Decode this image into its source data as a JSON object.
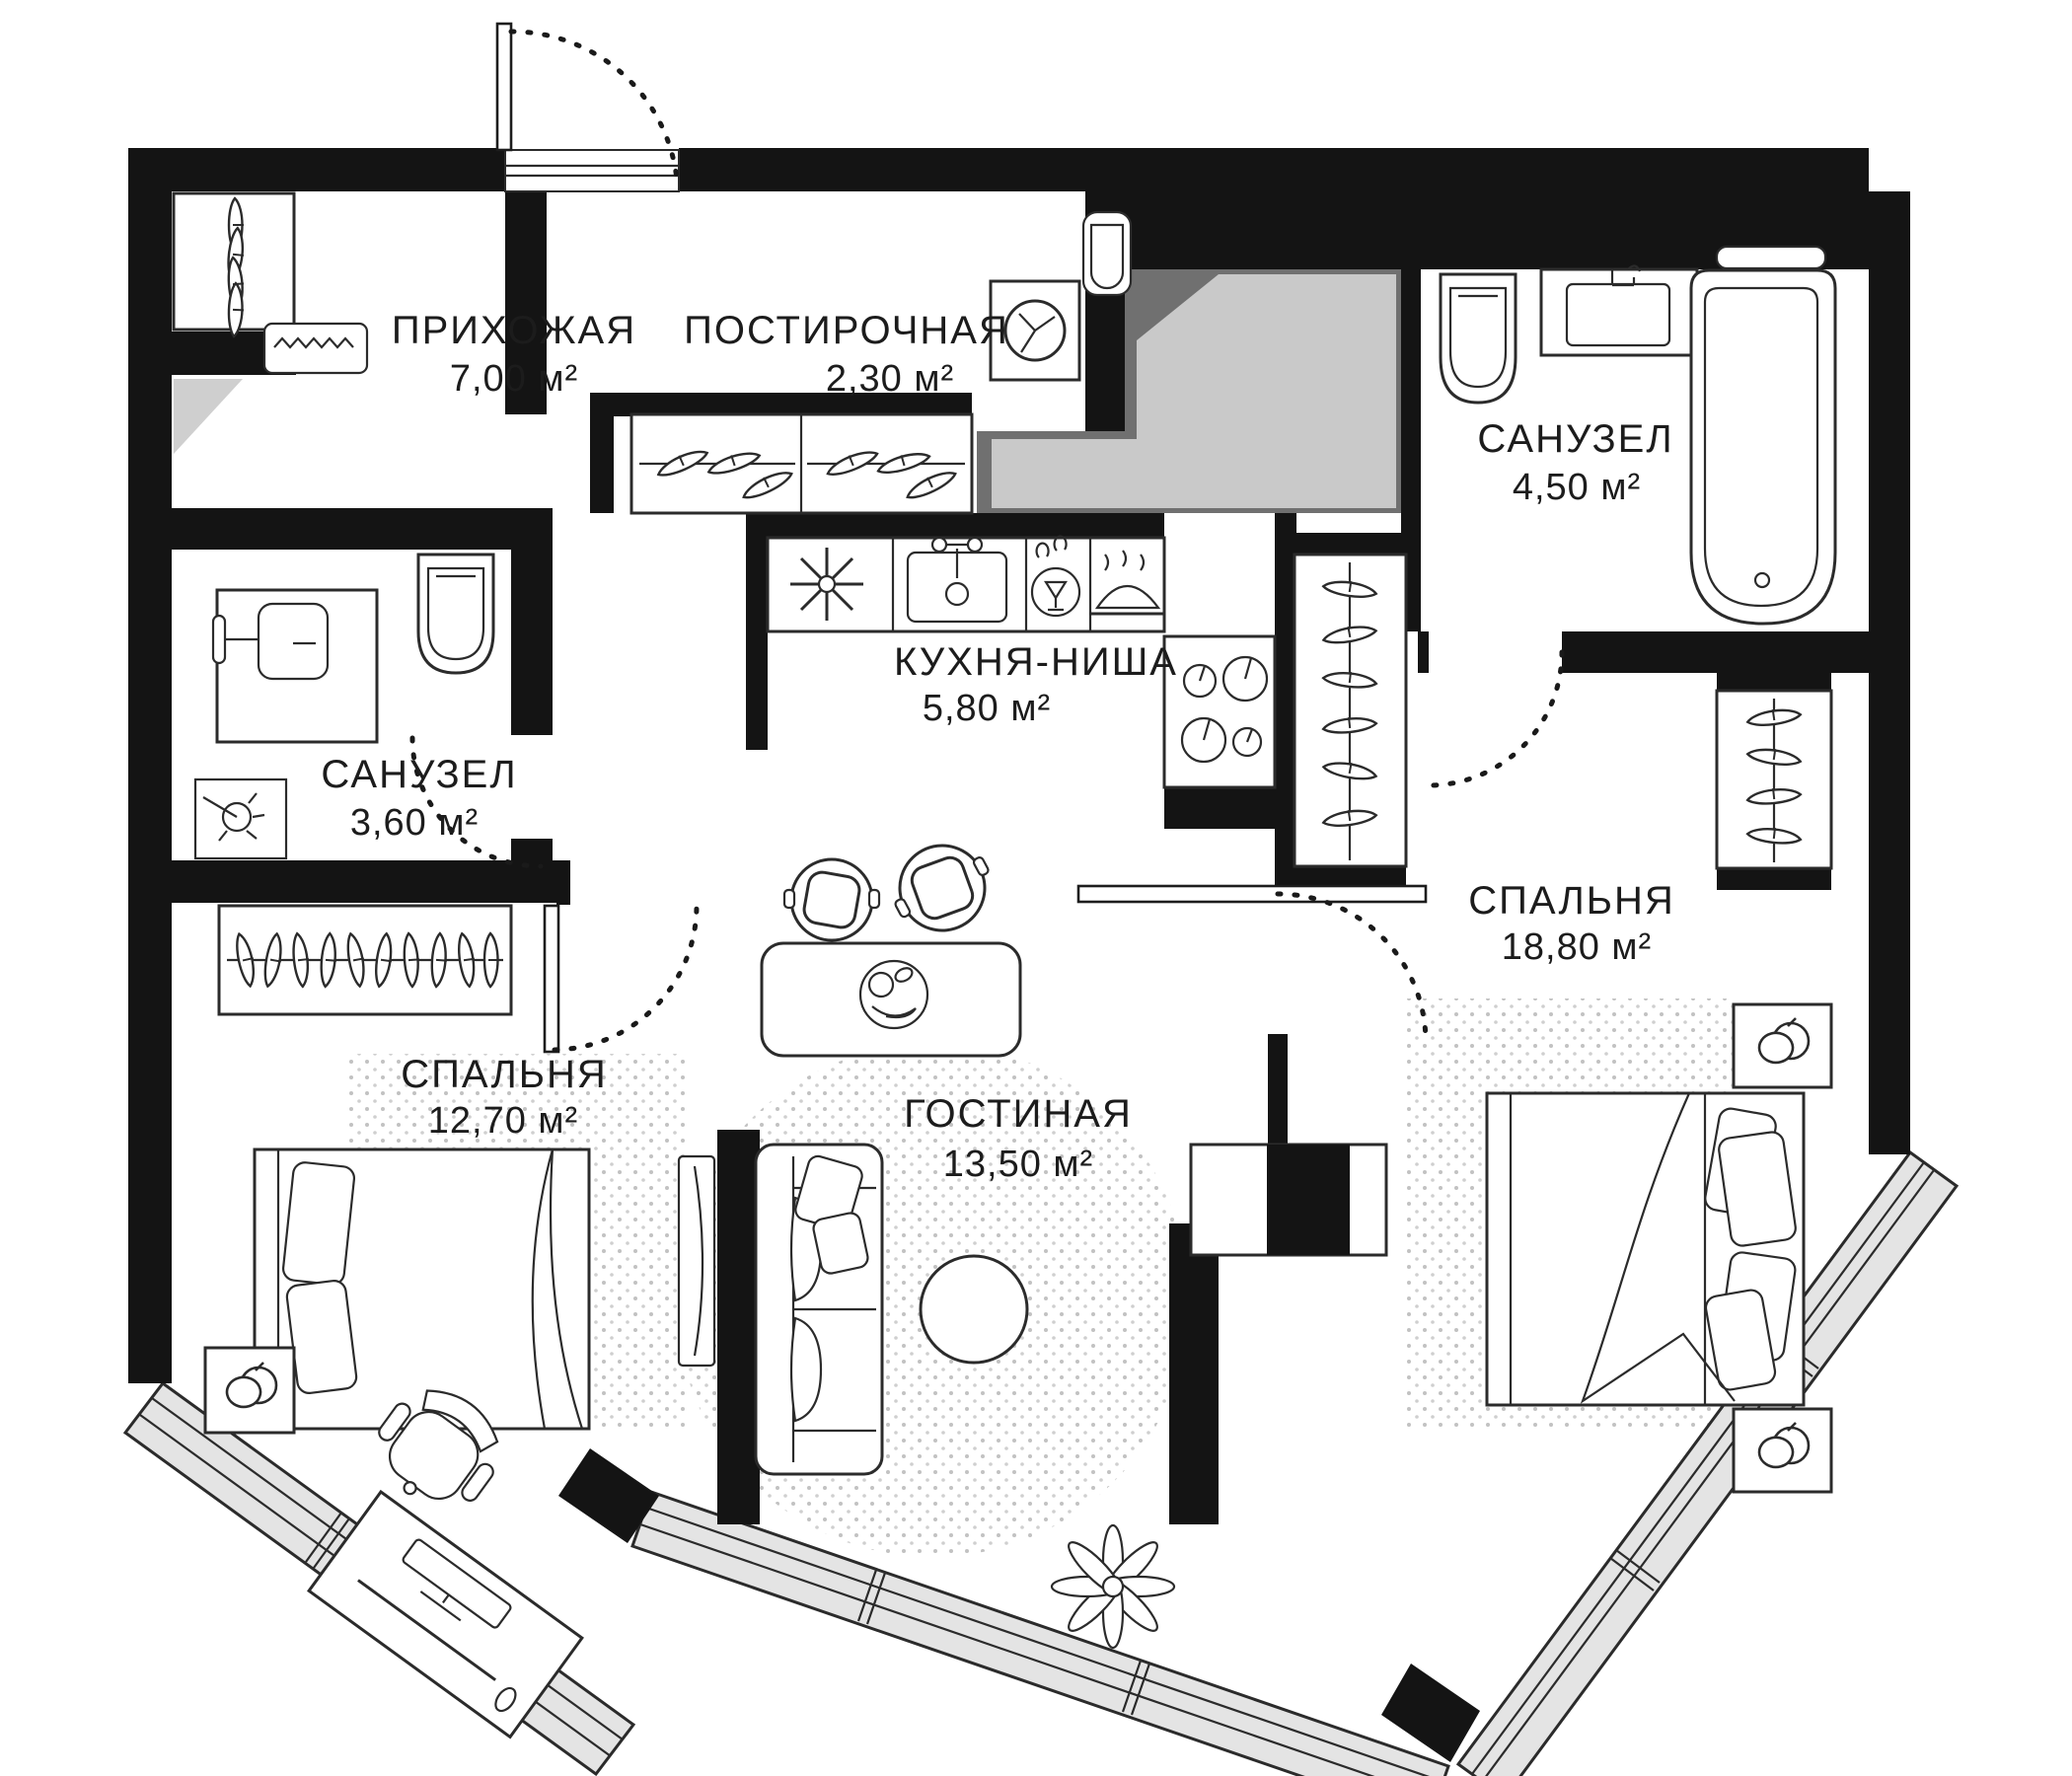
{
  "plan": {
    "type": "apartment-floor-plan",
    "units_symbol": "м²",
    "rooms": [
      {
        "id": "hallway",
        "name": "ПРИХОЖАЯ",
        "area": "7,00 м²"
      },
      {
        "id": "laundry",
        "name": "ПОСТИРОЧНАЯ",
        "area": "2,30 м²"
      },
      {
        "id": "bathroom-right",
        "name": "САНУЗЕЛ",
        "area": "4,50 м²"
      },
      {
        "id": "kitchen-niche",
        "name": "КУХНЯ-НИША",
        "area": "5,80 м²"
      },
      {
        "id": "bathroom-left",
        "name": "САНУЗЕЛ",
        "area": "3,60 м²"
      },
      {
        "id": "bedroom-right",
        "name": "СПАЛЬНЯ",
        "area": "18,80 м²"
      },
      {
        "id": "bedroom-left",
        "name": "СПАЛЬНЯ",
        "area": "12,70 м²"
      },
      {
        "id": "living-room",
        "name": "ГОСТИНАЯ",
        "area": "13,50 м²"
      }
    ],
    "colors": {
      "wall": "#141414",
      "floor": "#ffffff",
      "shaft_dark": "#707070",
      "shaft_light": "#c9c9c9",
      "window_band": "#e4e4e4",
      "rug_dots": "#c2c2c2",
      "line": "#2b2b2b"
    },
    "icons": [
      "clothes-hanger-icon",
      "washing-machine-icon",
      "wall-sink-icon",
      "toilet-icon",
      "vanity-sink-icon",
      "bathtub-icon",
      "shower-head-icon",
      "fridge-snowflake-icon",
      "kitchen-sink-icon",
      "dishwasher-icon",
      "oven-icon",
      "stove-burners-icon",
      "dining-table-icon",
      "fruit-bowl-icon",
      "chair-icon",
      "sofa-icon",
      "coffee-table-icon",
      "plant-icon",
      "tv-icon",
      "tv-console-icon",
      "bed-icon",
      "nightstand-icon",
      "desk-icon",
      "office-chair-icon",
      "door-swing-arc-icon",
      "window-bay-icon",
      "doormat-icon"
    ]
  }
}
